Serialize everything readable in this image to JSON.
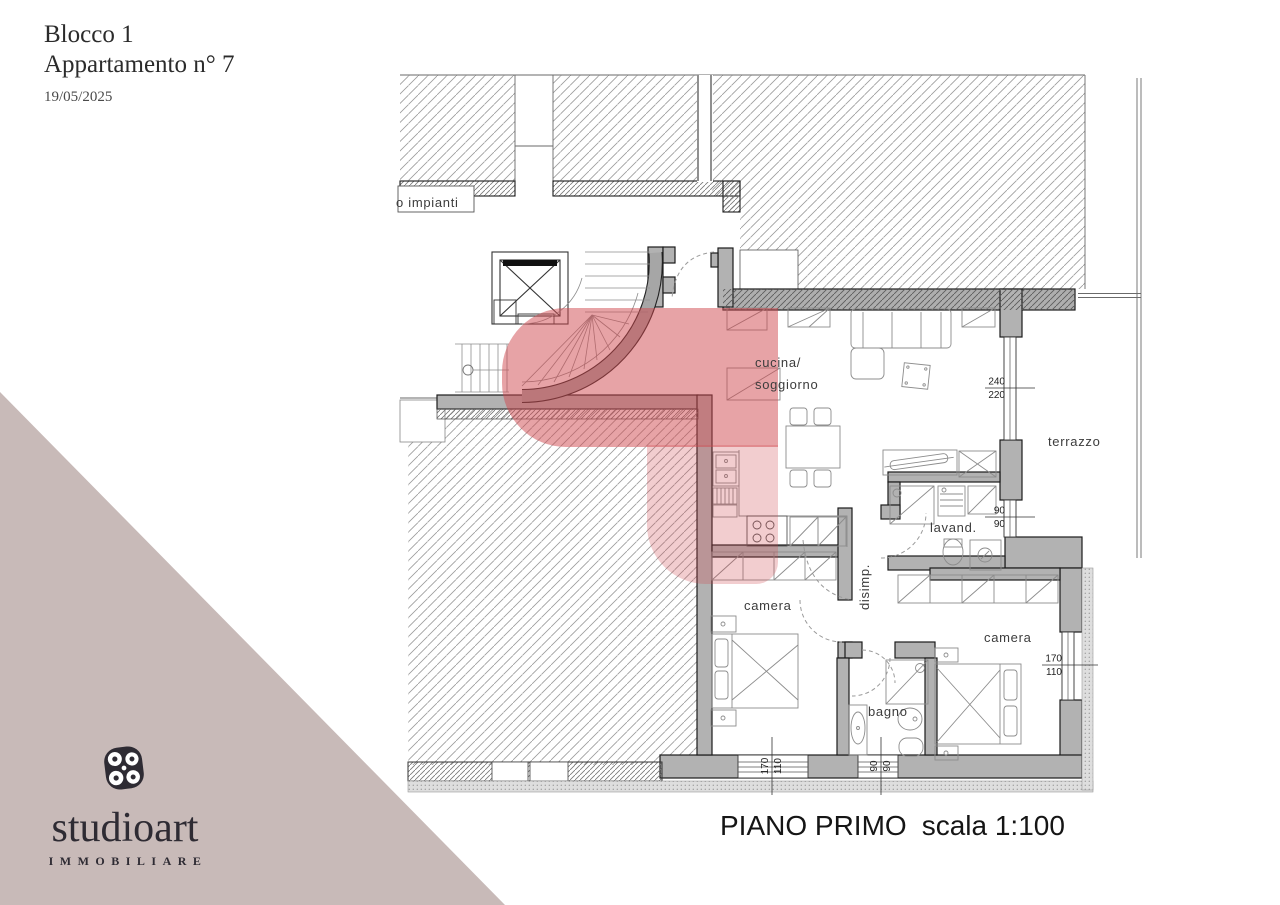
{
  "header": {
    "block": "Blocco 1",
    "apartment": "Appartamento n° 7",
    "date": "19/05/2025"
  },
  "brand": {
    "name": "studioart",
    "tagline": "IMMOBILIARE"
  },
  "plan": {
    "title_main": "PIANO PRIMO",
    "title_scale": "scala 1:100",
    "rooms": {
      "impianti": "o impianti",
      "cucina_l1": "cucina/",
      "cucina_l2": "soggiorno",
      "terrazzo": "terrazzo",
      "lavanderia": "lavand.",
      "disimpegno": "disimp.",
      "camera1": "camera",
      "camera2": "camera",
      "bagno": "bagno"
    },
    "dims": {
      "terrace_window": {
        "a": "240",
        "b": "220"
      },
      "lavand_window": {
        "a": "90",
        "b": "90"
      },
      "camera2_window": {
        "a": "170",
        "b": "110"
      },
      "camera1_window": {
        "a": "170",
        "b": "110"
      },
      "bagno_window": {
        "a": "90",
        "b": "90"
      }
    },
    "colors": {
      "highlight": "#d0484e",
      "wall": "#b2b2b2",
      "triangle": "#c8bab8",
      "logo": "#2e2b33"
    }
  }
}
